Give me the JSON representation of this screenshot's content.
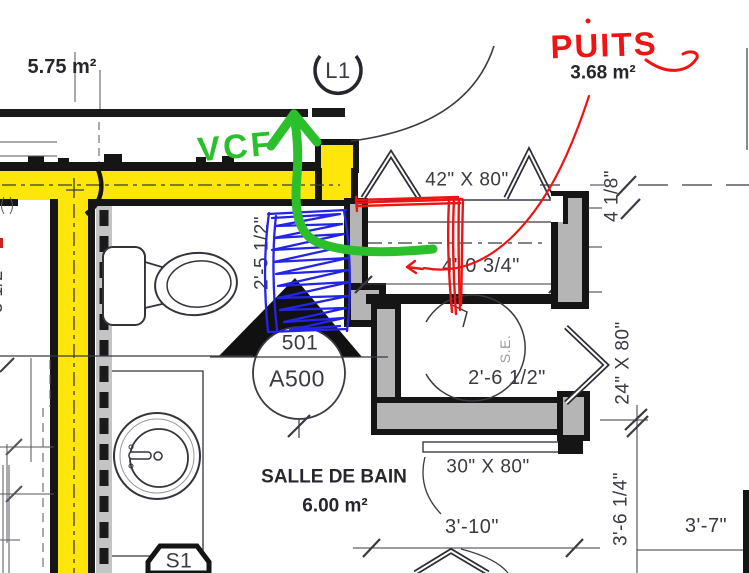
{
  "plan": {
    "areas": {
      "top_left_area": "5.75 m²",
      "well_area": "3.68 m²",
      "bathroom_name": "SALLE DE BAIN",
      "bathroom_area": "6.00 m²"
    },
    "tags": {
      "level_tag": "L1",
      "section_number": "501",
      "section_sheet": "A500",
      "fixture_tag": "S1",
      "door_swing_label": "S.E."
    },
    "dimensions": {
      "door_42x80": "42\" X 80\"",
      "dim_4_1_8": "4 1/8\"",
      "dim_2_5_1_2": "2'-5 1/2\"",
      "dim_4_0_3_4": "4'-0 3/4\"",
      "dim_2_6_1_2": "2'-6 1/2\"",
      "door_24x80": "24\" X 80\"",
      "door_30x80": "30\" X 80\"",
      "dim_3_10": "3'-10\"",
      "dim_3_7": "3'-7\"",
      "dim_3_6_1_4": "3'-6 1/4\"",
      "edge_fragment": "5 1/2\""
    },
    "handwritten": {
      "red_label": "PUITS",
      "green_label": "VCF"
    },
    "colors": {
      "highlight_yellow": "#FFE60A",
      "wall_gray": "#B5B5B5",
      "marker_red": "#EE1414",
      "marker_green": "#2BBF2B",
      "marker_blue": "#2424E8",
      "line_dark": "#3A3A42"
    }
  }
}
